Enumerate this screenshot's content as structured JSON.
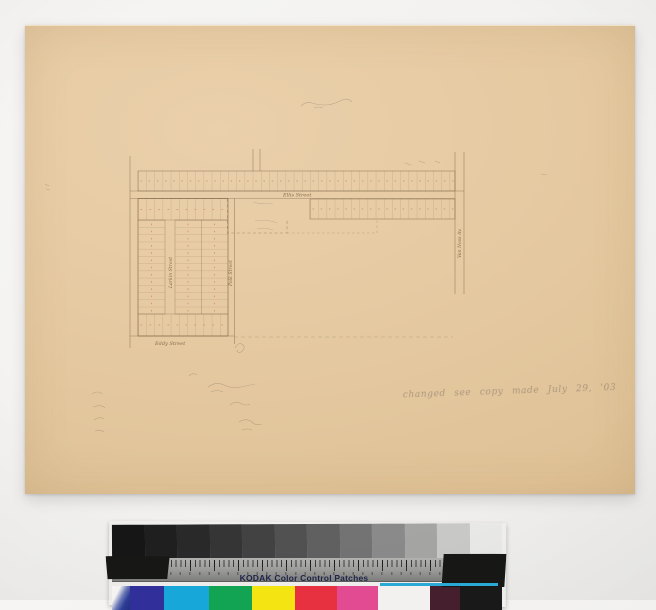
{
  "photo": {
    "background": "#f2f1ef",
    "paper_color": "#e5c9a1"
  },
  "map": {
    "ink_color": "#7a6142",
    "lot_mark_color": "#c6683a",
    "streets": [
      {
        "id": "ellis",
        "label": "Ellis Street"
      },
      {
        "id": "eddy",
        "label": "Eddy Street"
      },
      {
        "id": "larkin",
        "label": "Larkin Street"
      },
      {
        "id": "polk",
        "label": "Polk Street"
      },
      {
        "id": "vanness",
        "label": "Van Ness Av."
      }
    ],
    "annotation": "changed   see copy made July 29, '03"
  },
  "calibration": {
    "title": "KODAK Color Control Patches",
    "grayscale": [
      "#161616",
      "#1f1f1f",
      "#292929",
      "#353535",
      "#424242",
      "#515151",
      "#606060",
      "#737373",
      "#8a8a8a",
      "#a5a5a3",
      "#c9c9c7",
      "#e9e9e7"
    ],
    "patches": [
      {
        "name": "blue",
        "hex": "#31309a"
      },
      {
        "name": "cyan",
        "hex": "#18a7d9"
      },
      {
        "name": "green",
        "hex": "#12a452"
      },
      {
        "name": "yellow",
        "hex": "#f3e412"
      },
      {
        "name": "red",
        "hex": "#e73040"
      },
      {
        "name": "magenta",
        "hex": "#e24a92"
      },
      {
        "name": "white",
        "hex": "#f3f1ef"
      },
      {
        "name": "maroon",
        "hex": "#451f2e"
      },
      {
        "name": "black",
        "hex": "#191919"
      }
    ]
  }
}
